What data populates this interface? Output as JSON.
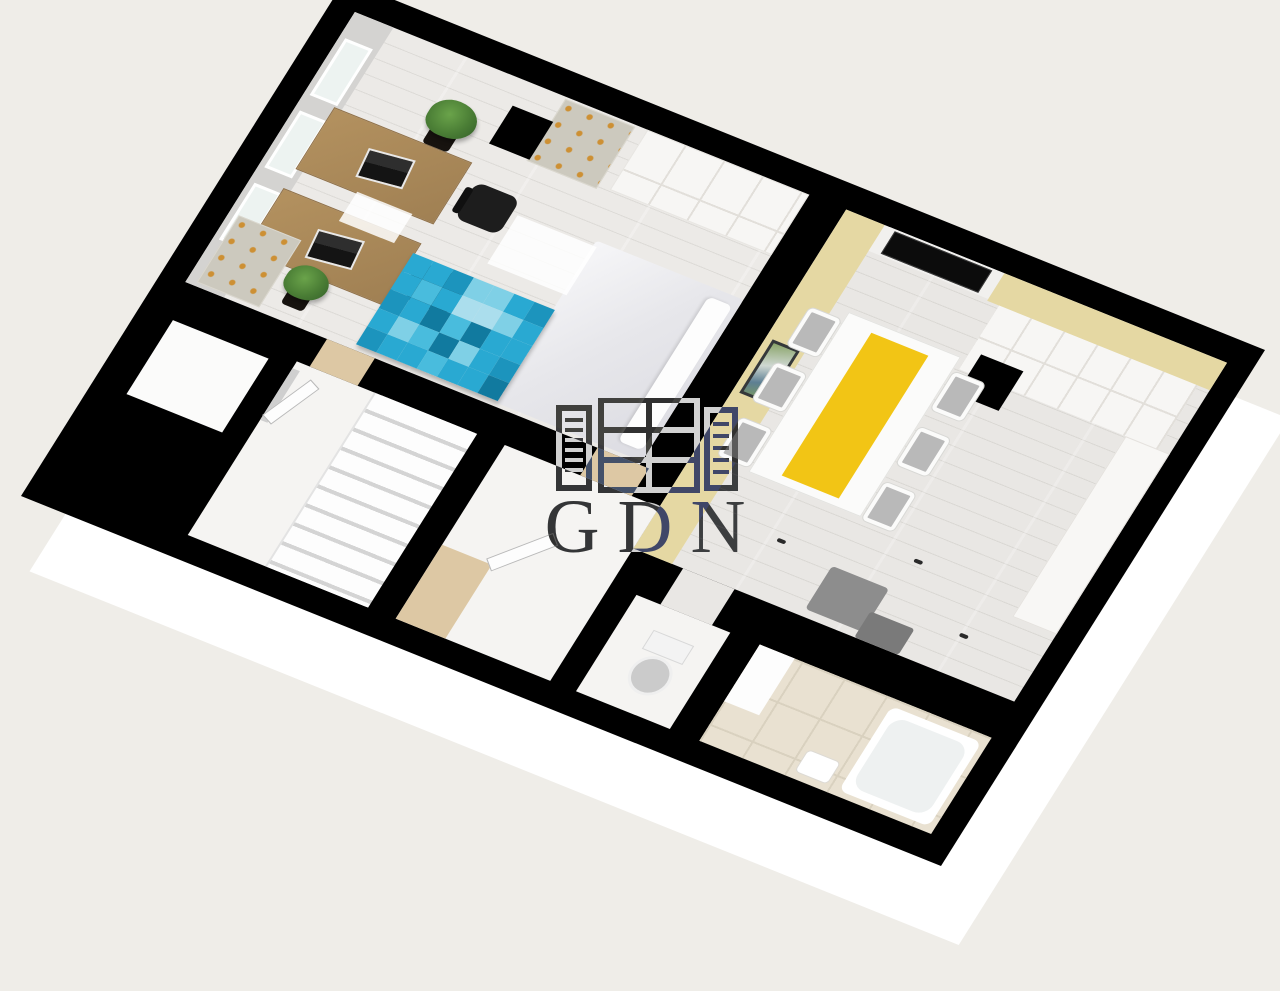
{
  "scene": {
    "type": "3d-floorplan-render",
    "view": "isometric-tilted",
    "objects": [
      "office-desk",
      "laptop",
      "office-chair",
      "potted-plant",
      "wardrobe",
      "chest-of-drawers",
      "column-pillar",
      "double-bed",
      "patchwork-rug",
      "wall-tv",
      "picture-frame",
      "dining-table",
      "table-runner",
      "dining-chair",
      "kitchen-cabinets",
      "kitchen-counter",
      "armchair",
      "staircase",
      "interior-door",
      "toilet",
      "bathtub",
      "wash-basin",
      "window"
    ],
    "counts": {
      "windows": 3,
      "desks": 2,
      "office_chairs": 2,
      "dining_chairs": 6,
      "plants": 3
    }
  },
  "watermark": {
    "text": "GDN",
    "logo_icon": "building-logo-icon",
    "color": "#ffffff",
    "blend": "difference"
  },
  "colors": {
    "background": "#efede8",
    "walls": "#000000",
    "foundation_slab": "#ffffff",
    "floor_plank": "#eceae7",
    "accent_wall_yellow": "#e5d8a3",
    "table_runner_yellow": "#f2c515",
    "bathroom_tile": "#e9e1d1",
    "hall_threshold_beige": "#ddc8a4",
    "desk_wood": "#ab8a60",
    "chair_black": "#1d1d1d",
    "chest_knob_gold": "#cd9034",
    "plant_green": "#4a7d35"
  },
  "rug": {
    "cols": 7,
    "rows": 5,
    "palette": [
      "#117a9f",
      "#1c94bd",
      "#29a9d2",
      "#49bcdd",
      "#7fd0e6",
      "#abdeed"
    ],
    "cells": [
      [
        2,
        2,
        1,
        4,
        4,
        2,
        1
      ],
      [
        2,
        3,
        2,
        5,
        5,
        4,
        2
      ],
      [
        1,
        2,
        0,
        3,
        0,
        2,
        2
      ],
      [
        2,
        4,
        3,
        0,
        4,
        2,
        1
      ],
      [
        1,
        2,
        2,
        3,
        2,
        2,
        0
      ]
    ]
  }
}
